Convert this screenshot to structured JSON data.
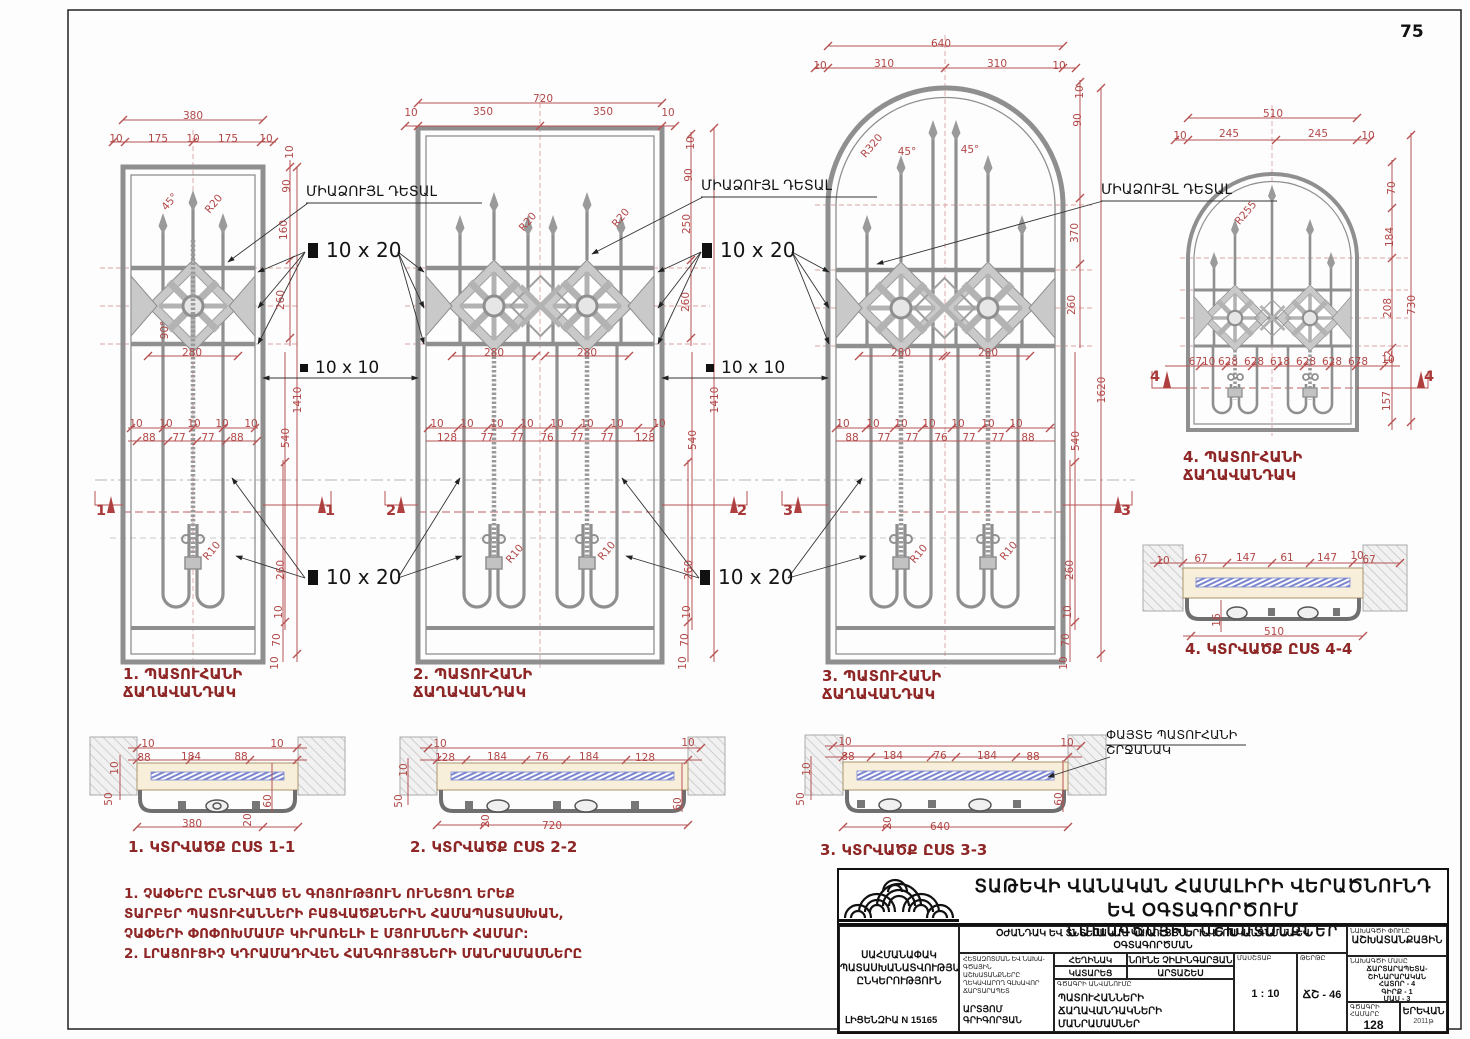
{
  "page": {
    "number": "75"
  },
  "colors": {
    "dim_red": "#b24747",
    "title_maroon": "#8e2626",
    "line_gray": "#8f8f8f",
    "glass_blue": "#7b86cf"
  },
  "callouts": {
    "monolith": "ՄԻԱՁՈՒՅԼ ԴԵՏԱԼ",
    "bar_10x20": "10 x 20",
    "bar_10x10": "10 x 10",
    "wood1": "ՓԱՅՏԵ ՊԱՏՈՒՀԱՆԻ",
    "wood2": "ՇՐՋԱՆԱԿ"
  },
  "drawings": {
    "d1": [
      "1. ՊԱՏՈՒՀԱՆԻ",
      "ՃԱՂԱՎԱՆԴԱԿ"
    ],
    "d2": [
      "2. ՊԱՏՈՒՀԱՆԻ",
      "ՃԱՂԱՎԱՆԴԱԿ"
    ],
    "d3": [
      "3. ՊԱՏՈՒՀԱՆԻ",
      "ՃԱՂԱՎԱՆԴԱԿ"
    ],
    "d4": [
      "4. ՊԱՏՈՒՀԱՆԻ",
      "ՃԱՂԱՎԱՆԴԱԿ"
    ]
  },
  "sections": {
    "s1": "1. ԿՏՐՎԱԾՔ ԸՍՏ 1-1",
    "s2": "2. ԿՏՐՎԱԾՔ ԸՍՏ 2-2",
    "s3": "3. ԿՏՐՎԱԾՔ ԸՍՏ 3-3",
    "s4": "4. ԿՏՐՎԱԾՔ ԸՍՏ 4-4"
  },
  "notes": {
    "l1": "1. ՉԱՓԵՐԸ ԸՆՏՐՎԱԾ ԵՆ ԳՈՅՈՒԹՅՈՒՆ ՈՒՆԵՑՈՂ ԵՐԵՔ",
    "l2": "ՏԱՐԲԵՐ ՊԱՏՈՒՀԱՆՆԵՐԻ ԲԱՑՎԱԾՔՆԵՐԻՆ ՀԱՄԱՊԱՏԱՍԽԱՆ,",
    "l3": "ՉԱՓԵՐԻ ՓՈՓՈԽՄԱՄԲ ԿԻՐԱՌԵԼԻ Է ՄՅՈՒՍՆԵՐԻ ՀԱՄԱՐ:",
    "l4": "2. ԼՐԱՑՈՒՑԻՉ ԿԴՐԱՄԱԴՐՎԵՆ ՀԱՆԳՈՒՅՑՆԵՐԻ ՄԱՆՐԱՄԱՍՆԵՐԸ"
  },
  "tb": {
    "header1": "ՏԱԹԵՎԻ ՎԱՆԱԿԱՆ ՀԱՄԱԼԻՐԻ ՎԵՐԱԾՆՈՒՆԴ ԵՎ ՕԳՏԱԳՈՐԾՈՒՄ",
    "header2": "ՆԱԽԱԳԾԱՅԻՆ ԱՇԽԱՏԱՆՔՆԵՐ",
    "company1": "ՍԱՀՄԱՆԱՓԱԿ",
    "company2": "ՊԱՏԱՍԽԱՆԱՏՎՈՒԹՅԱՄԲ",
    "company3": "ԸՆԿԵՐՈՒԹՅՈՒՆ",
    "license": "ԼԻՑԵՆԶԻԱ N 15165",
    "project1": "ՕԺԱՆԴԱԿ ԵՎ ՏՆՏԵՍԱԿԱՆ ԿԱՌՈՒՅՑՆԵՐԻ ՎԵՐԱԿԱՆԳՆՄԱՆ ԵՎ ՕԳՏԱԳՈՐԾՄԱՆ",
    "project2": "ԱՇԽԱՏԱՆՔԱՅԻՆ ԳԾԱԳՐԵՐ.   ԹԱՆԳԱՐԱՆԱՅԻՆ ՄԱՍՆԱՇԵՆՔԵՐ",
    "arch_cap1": "ՀԵՏԱԶՈՏՄԱՆ ԵՎ ՆԱԽԱ-",
    "arch_cap2": "ԳԾԱՅԻՆ ԱՇԽԱՏԱՆՔՆԵՐԸ",
    "arch_cap3": "ՂԵԿԱՎԱՐՈՂ ԳԼԽԱՎՈՐ",
    "arch_cap4": "ՃԱՐՏԱՐԱՊԵՏ",
    "arch_name": "ԱՐՏՅՈՄ ԳՐԻԳՈՐՅԱՆ",
    "author_label": "ՀԵՂԻՆԱԿ",
    "author_name": "ՆՈՒՆԵ ՉԻԼԻՆԳԱՐՅԱՆ",
    "performed_label": "ԿԱՏԱՐԵՑ",
    "performer_name": "ԱՐՏԱՇԵՍ ԳՐԻԳՈՐՅԱՆ",
    "name_caption": "ԳԾԱԳՐԻ ԱՆՎԱՆՈՒՄԸ",
    "drawing_name1": "ՊԱՏՈՒՀԱՆՆԵՐԻ ՃԱՂԱՎԱՆԴԱԿՆԵՐԻ",
    "drawing_name2": "ՄԱՆՐԱՄԱՍՆԵՐ",
    "scale_caption": "ՄԱՍՇՏԱԲ",
    "scale_value": "1 : 10",
    "sheet_caption": "ԹԵՐԹԸ",
    "sheet_value": "ՃՇ - 46",
    "phase_caption": "ՆԱԽԱԳԾԻ ՓՈՒԼԸ",
    "phase_value": "ԱՇԽԱՏԱՆՔԱՅԻՆ",
    "part_caption": "ՆԱԽԱԳԾԻ ՄԱՍԸ",
    "part1": "ՃԱՐՏԱՐԱՊԵՏԱ-",
    "part2": "ՇԻՆԱՐԱՐԱԿԱՆ",
    "part3": "ՀԱՏՈՐ - 4",
    "part4": "ԳԻՐՔ - 1",
    "part5": "ՄԱՍ - 3",
    "number_caption": "ԳԾԱԳՐԻ ՀԱՄԱՐԸ",
    "number_value": "128",
    "city": "ԵՐԵՎԱՆ",
    "year": "2011թ"
  },
  "dims": {
    "labels": [
      {
        "t": "380",
        "x": 193,
        "y": 116
      },
      {
        "t": "10",
        "x": 116,
        "y": 139
      },
      {
        "t": "175",
        "x": 158,
        "y": 139
      },
      {
        "t": "10",
        "x": 193,
        "y": 139
      },
      {
        "t": "175",
        "x": 228,
        "y": 139
      },
      {
        "t": "10",
        "x": 266,
        "y": 139
      },
      {
        "t": "10",
        "x": 290,
        "y": 152,
        "r": "v"
      },
      {
        "t": "90",
        "x": 287,
        "y": 186,
        "r": "v"
      },
      {
        "t": "160",
        "x": 284,
        "y": 230,
        "r": "v"
      },
      {
        "t": "260",
        "x": 281,
        "y": 300,
        "r": "v"
      },
      {
        "t": "45°",
        "x": 170,
        "y": 202,
        "r": "d"
      },
      {
        "t": "R20",
        "x": 214,
        "y": 204,
        "r": "d"
      },
      {
        "t": "90°",
        "x": 165,
        "y": 330,
        "r": "v"
      },
      {
        "t": "280",
        "x": 192,
        "y": 353
      },
      {
        "t": "1410",
        "x": 298,
        "y": 400,
        "r": "v"
      },
      {
        "t": "540",
        "x": 286,
        "y": 438,
        "r": "v"
      },
      {
        "t": "10",
        "x": 136,
        "y": 424
      },
      {
        "t": "10",
        "x": 166,
        "y": 424
      },
      {
        "t": "10",
        "x": 194,
        "y": 424
      },
      {
        "t": "10",
        "x": 222,
        "y": 424
      },
      {
        "t": "10",
        "x": 251,
        "y": 424
      },
      {
        "t": "88",
        "x": 149,
        "y": 438
      },
      {
        "t": "77",
        "x": 179,
        "y": 438
      },
      {
        "t": "77",
        "x": 208,
        "y": 438
      },
      {
        "t": "88",
        "x": 237,
        "y": 438
      },
      {
        "t": "260",
        "x": 281,
        "y": 570,
        "r": "v"
      },
      {
        "t": "10",
        "x": 279,
        "y": 612,
        "r": "v"
      },
      {
        "t": "70",
        "x": 277,
        "y": 640,
        "r": "v"
      },
      {
        "t": "10",
        "x": 275,
        "y": 663,
        "r": "v"
      },
      {
        "t": "R10",
        "x": 212,
        "y": 551,
        "r": "d"
      },
      {
        "t": "1",
        "x": 101,
        "y": 511,
        "c": "mk"
      },
      {
        "t": "1",
        "x": 330,
        "y": 511,
        "c": "mk"
      },
      {
        "t": "720",
        "x": 543,
        "y": 99
      },
      {
        "t": "10",
        "x": 411,
        "y": 113
      },
      {
        "t": "350",
        "x": 483,
        "y": 112
      },
      {
        "t": "350",
        "x": 603,
        "y": 112
      },
      {
        "t": "10",
        "x": 668,
        "y": 113
      },
      {
        "t": "10",
        "x": 691,
        "y": 143,
        "r": "v"
      },
      {
        "t": "90",
        "x": 689,
        "y": 175,
        "r": "v"
      },
      {
        "t": "250",
        "x": 687,
        "y": 224,
        "r": "v"
      },
      {
        "t": "260",
        "x": 686,
        "y": 302,
        "r": "v"
      },
      {
        "t": "R20",
        "x": 528,
        "y": 222,
        "r": "d"
      },
      {
        "t": "R20",
        "x": 621,
        "y": 218,
        "r": "d"
      },
      {
        "t": "280",
        "x": 494,
        "y": 353
      },
      {
        "t": "280",
        "x": 587,
        "y": 353
      },
      {
        "t": "1410",
        "x": 715,
        "y": 400,
        "r": "v"
      },
      {
        "t": "540",
        "x": 693,
        "y": 440,
        "r": "v"
      },
      {
        "t": "10",
        "x": 437,
        "y": 424
      },
      {
        "t": "10",
        "x": 467,
        "y": 424
      },
      {
        "t": "10",
        "x": 497,
        "y": 424
      },
      {
        "t": "10",
        "x": 527,
        "y": 424
      },
      {
        "t": "10",
        "x": 557,
        "y": 424
      },
      {
        "t": "10",
        "x": 587,
        "y": 424
      },
      {
        "t": "10",
        "x": 617,
        "y": 424
      },
      {
        "t": "10",
        "x": 659,
        "y": 424
      },
      {
        "t": "128",
        "x": 447,
        "y": 438
      },
      {
        "t": "77",
        "x": 487,
        "y": 438
      },
      {
        "t": "77",
        "x": 517,
        "y": 438
      },
      {
        "t": "76",
        "x": 547,
        "y": 438
      },
      {
        "t": "77",
        "x": 577,
        "y": 438
      },
      {
        "t": "77",
        "x": 607,
        "y": 438
      },
      {
        "t": "128",
        "x": 645,
        "y": 438
      },
      {
        "t": "260",
        "x": 689,
        "y": 570,
        "r": "v"
      },
      {
        "t": "10",
        "x": 687,
        "y": 612,
        "r": "v"
      },
      {
        "t": "70",
        "x": 685,
        "y": 640,
        "r": "v"
      },
      {
        "t": "10",
        "x": 683,
        "y": 663,
        "r": "v"
      },
      {
        "t": "R10",
        "x": 515,
        "y": 554,
        "r": "d"
      },
      {
        "t": "R10",
        "x": 607,
        "y": 551,
        "r": "d"
      },
      {
        "t": "2",
        "x": 391,
        "y": 511,
        "c": "mk"
      },
      {
        "t": "2",
        "x": 742,
        "y": 511,
        "c": "mk"
      },
      {
        "t": "640",
        "x": 941,
        "y": 44
      },
      {
        "t": "10",
        "x": 820,
        "y": 66
      },
      {
        "t": "310",
        "x": 884,
        "y": 64
      },
      {
        "t": "310",
        "x": 997,
        "y": 64
      },
      {
        "t": "10",
        "x": 1059,
        "y": 66
      },
      {
        "t": "R320",
        "x": 872,
        "y": 146,
        "r": "d"
      },
      {
        "t": "45°",
        "x": 907,
        "y": 152
      },
      {
        "t": "45°",
        "x": 970,
        "y": 150
      },
      {
        "t": "10",
        "x": 1080,
        "y": 92,
        "r": "v"
      },
      {
        "t": "90",
        "x": 1078,
        "y": 120,
        "r": "v"
      },
      {
        "t": "370",
        "x": 1075,
        "y": 233,
        "r": "v"
      },
      {
        "t": "260",
        "x": 1072,
        "y": 305,
        "r": "v"
      },
      {
        "t": "1620",
        "x": 1102,
        "y": 390,
        "r": "v"
      },
      {
        "t": "540",
        "x": 1076,
        "y": 441,
        "r": "v"
      },
      {
        "t": "280",
        "x": 901,
        "y": 353
      },
      {
        "t": "280",
        "x": 988,
        "y": 353
      },
      {
        "t": "10",
        "x": 843,
        "y": 424
      },
      {
        "t": "10",
        "x": 873,
        "y": 424
      },
      {
        "t": "10",
        "x": 901,
        "y": 424
      },
      {
        "t": "10",
        "x": 929,
        "y": 424
      },
      {
        "t": "10",
        "x": 958,
        "y": 424
      },
      {
        "t": "10",
        "x": 988,
        "y": 424
      },
      {
        "t": "10",
        "x": 1016,
        "y": 424
      },
      {
        "t": "88",
        "x": 852,
        "y": 438
      },
      {
        "t": "77",
        "x": 884,
        "y": 438
      },
      {
        "t": "77",
        "x": 912,
        "y": 438
      },
      {
        "t": "76",
        "x": 941,
        "y": 438
      },
      {
        "t": "77",
        "x": 969,
        "y": 438
      },
      {
        "t": "77",
        "x": 998,
        "y": 438
      },
      {
        "t": "88",
        "x": 1028,
        "y": 438
      },
      {
        "t": "260",
        "x": 1070,
        "y": 570,
        "r": "v"
      },
      {
        "t": "10",
        "x": 1068,
        "y": 612,
        "r": "v"
      },
      {
        "t": "70",
        "x": 1066,
        "y": 640,
        "r": "v"
      },
      {
        "t": "10",
        "x": 1064,
        "y": 663,
        "r": "v"
      },
      {
        "t": "R10",
        "x": 919,
        "y": 554,
        "r": "d"
      },
      {
        "t": "R10",
        "x": 1009,
        "y": 551,
        "r": "d"
      },
      {
        "t": "3",
        "x": 788,
        "y": 511,
        "c": "mk"
      },
      {
        "t": "3",
        "x": 1126,
        "y": 511,
        "c": "mk"
      },
      {
        "t": "510",
        "x": 1273,
        "y": 114
      },
      {
        "t": "10",
        "x": 1180,
        "y": 136
      },
      {
        "t": "245",
        "x": 1229,
        "y": 134
      },
      {
        "t": "245",
        "x": 1318,
        "y": 134
      },
      {
        "t": "10",
        "x": 1368,
        "y": 136
      },
      {
        "t": "R255",
        "x": 1246,
        "y": 213,
        "r": "d"
      },
      {
        "t": "70",
        "x": 1392,
        "y": 188,
        "r": "v"
      },
      {
        "t": "184",
        "x": 1390,
        "y": 237,
        "r": "v"
      },
      {
        "t": "208",
        "x": 1388,
        "y": 308,
        "r": "v"
      },
      {
        "t": "12",
        "x": 1389,
        "y": 357,
        "r": "v"
      },
      {
        "t": "157",
        "x": 1387,
        "y": 401,
        "r": "v"
      },
      {
        "t": "730",
        "x": 1412,
        "y": 305,
        "r": "v"
      },
      {
        "t": "6710",
        "x": 1202,
        "y": 362
      },
      {
        "t": "628",
        "x": 1228,
        "y": 362
      },
      {
        "t": "628",
        "x": 1254,
        "y": 362
      },
      {
        "t": "618",
        "x": 1280,
        "y": 362
      },
      {
        "t": "628",
        "x": 1306,
        "y": 362
      },
      {
        "t": "628",
        "x": 1332,
        "y": 362
      },
      {
        "t": "678",
        "x": 1358,
        "y": 362
      },
      {
        "t": "10",
        "x": 1388,
        "y": 360
      },
      {
        "t": "4",
        "x": 1155,
        "y": 377,
        "c": "mk"
      },
      {
        "t": "4",
        "x": 1429,
        "y": 377,
        "c": "mk"
      },
      {
        "t": "10",
        "x": 148,
        "y": 744
      },
      {
        "t": "10",
        "x": 277,
        "y": 744
      },
      {
        "t": "88",
        "x": 144,
        "y": 758
      },
      {
        "t": "184",
        "x": 191,
        "y": 757
      },
      {
        "t": "88",
        "x": 241,
        "y": 757
      },
      {
        "t": "10",
        "x": 115,
        "y": 768,
        "r": "v"
      },
      {
        "t": "50",
        "x": 109,
        "y": 799,
        "r": "v"
      },
      {
        "t": "60",
        "x": 268,
        "y": 801,
        "r": "v"
      },
      {
        "t": "380",
        "x": 192,
        "y": 824
      },
      {
        "t": "20",
        "x": 248,
        "y": 820,
        "r": "v"
      },
      {
        "t": "10",
        "x": 440,
        "y": 744
      },
      {
        "t": "10",
        "x": 688,
        "y": 743
      },
      {
        "t": "128",
        "x": 445,
        "y": 758
      },
      {
        "t": "184",
        "x": 497,
        "y": 757
      },
      {
        "t": "76",
        "x": 542,
        "y": 757
      },
      {
        "t": "184",
        "x": 589,
        "y": 757
      },
      {
        "t": "128",
        "x": 645,
        "y": 758
      },
      {
        "t": "10",
        "x": 404,
        "y": 770,
        "r": "v"
      },
      {
        "t": "50",
        "x": 399,
        "y": 801,
        "r": "v"
      },
      {
        "t": "60",
        "x": 678,
        "y": 804,
        "r": "v"
      },
      {
        "t": "20",
        "x": 486,
        "y": 821,
        "r": "v"
      },
      {
        "t": "720",
        "x": 552,
        "y": 826
      },
      {
        "t": "10",
        "x": 845,
        "y": 742
      },
      {
        "t": "10",
        "x": 1067,
        "y": 743
      },
      {
        "t": "88",
        "x": 848,
        "y": 757
      },
      {
        "t": "184",
        "x": 893,
        "y": 756
      },
      {
        "t": "76",
        "x": 940,
        "y": 756
      },
      {
        "t": "184",
        "x": 987,
        "y": 756
      },
      {
        "t": "88",
        "x": 1033,
        "y": 757
      },
      {
        "t": "10",
        "x": 807,
        "y": 769,
        "r": "v"
      },
      {
        "t": "50",
        "x": 801,
        "y": 799,
        "r": "v"
      },
      {
        "t": "60",
        "x": 1059,
        "y": 799,
        "r": "v"
      },
      {
        "t": "20",
        "x": 888,
        "y": 823,
        "r": "v"
      },
      {
        "t": "640",
        "x": 940,
        "y": 827
      },
      {
        "t": "10",
        "x": 1163,
        "y": 561
      },
      {
        "t": "67",
        "x": 1201,
        "y": 559
      },
      {
        "t": "147",
        "x": 1246,
        "y": 558
      },
      {
        "t": "61",
        "x": 1287,
        "y": 558
      },
      {
        "t": "147",
        "x": 1327,
        "y": 558
      },
      {
        "t": "10",
        "x": 1357,
        "y": 556
      },
      {
        "t": "67",
        "x": 1369,
        "y": 560
      },
      {
        "t": "16",
        "x": 1217,
        "y": 620,
        "r": "v"
      },
      {
        "t": "510",
        "x": 1274,
        "y": 632
      }
    ]
  }
}
